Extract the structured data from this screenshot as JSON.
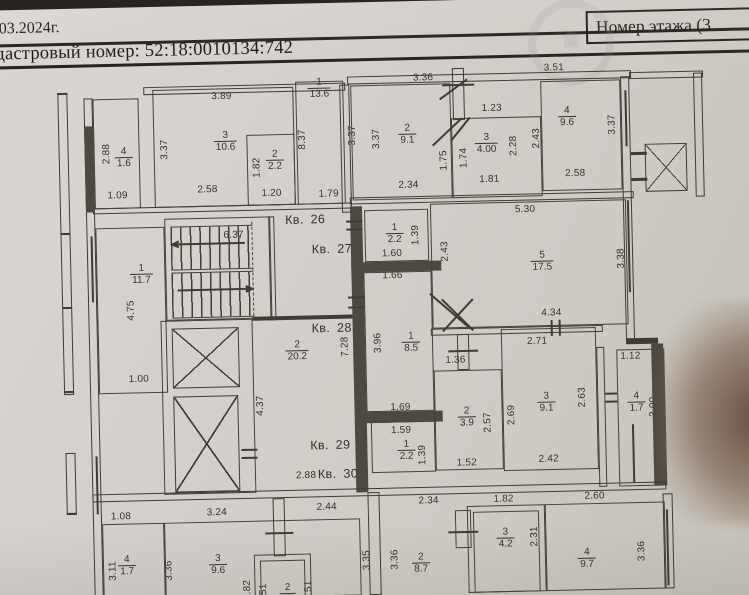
{
  "header": {
    "date_text": "03.2024г.",
    "cadastral_text": "дастровый номер: 52:18:0010134:742",
    "floor_box_label": "Номер этажа (3"
  },
  "colors": {
    "paper": "#d3d0cb",
    "ink": "#3f3c36",
    "header_ink": "#1d1b16"
  },
  "plan": {
    "apartment_labels": [
      {
        "text": "Кв. 26",
        "x": 307,
        "y": 218
      },
      {
        "text": "Кв. 27",
        "x": 333,
        "y": 248
      },
      {
        "text": "Кв. 28",
        "x": 331,
        "y": 327
      },
      {
        "text": "Кв. 29",
        "x": 327,
        "y": 444
      },
      {
        "text": "Кв. 30",
        "x": 334,
        "y": 473
      }
    ],
    "room_labels": [
      {
        "num": "4",
        "area": "1.6",
        "x": 127,
        "y": 152
      },
      {
        "num": "3",
        "area": "10.6",
        "x": 229,
        "y": 138
      },
      {
        "num": "2",
        "area": "2.2",
        "x": 278,
        "y": 158
      },
      {
        "num": "1",
        "area": "13.6",
        "x": 324,
        "y": 87
      },
      {
        "num": "2",
        "area": "9.1",
        "x": 411,
        "y": 135
      },
      {
        "num": "3",
        "area": "4.00",
        "x": 490,
        "y": 146
      },
      {
        "num": "4",
        "area": "9.6",
        "x": 571,
        "y": 121
      },
      {
        "num": "1",
        "area": "11.7",
        "x": 142,
        "y": 269
      },
      {
        "num": "1",
        "area": "2.2",
        "x": 396,
        "y": 234
      },
      {
        "num": "5",
        "area": "17.5",
        "x": 543,
        "y": 265
      },
      {
        "num": "2",
        "area": "20.2",
        "x": 296,
        "y": 349
      },
      {
        "num": "1",
        "area": "8.5",
        "x": 410,
        "y": 343
      },
      {
        "num": "1",
        "area": "2.2",
        "x": 403,
        "y": 451
      },
      {
        "num": "2",
        "area": "3.9",
        "x": 464,
        "y": 419
      },
      {
        "num": "3",
        "area": "9.1",
        "x": 544,
        "y": 406
      },
      {
        "num": "4",
        "area": "1.7",
        "x": 634,
        "y": 408
      },
      {
        "num": "4",
        "area": "1.7",
        "x": 121,
        "y": 560
      },
      {
        "num": "3",
        "area": "9.6",
        "x": 212,
        "y": 561
      },
      {
        "num": "2",
        "area": "8.7",
        "x": 415,
        "y": 564
      },
      {
        "num": "3",
        "area": "4.2",
        "x": 500,
        "y": 541
      },
      {
        "num": "4",
        "area": "9.7",
        "x": 581,
        "y": 563
      },
      {
        "num": "2",
        "area": "",
        "x": 281,
        "y": 586
      }
    ],
    "dim_labels": [
      {
        "text": "3.89",
        "x": 226,
        "y": 93
      },
      {
        "text": "2.88",
        "x": 110,
        "y": 148,
        "rot": true
      },
      {
        "text": "1.09",
        "x": 120,
        "y": 190
      },
      {
        "text": "3.37",
        "x": 168,
        "y": 145,
        "rot": true
      },
      {
        "text": "2.58",
        "x": 210,
        "y": 186
      },
      {
        "text": "1.82",
        "x": 260,
        "y": 165,
        "rot": true
      },
      {
        "text": "1.20",
        "x": 274,
        "y": 191
      },
      {
        "text": "8.37",
        "x": 306,
        "y": 138,
        "rot": true
      },
      {
        "text": "1.79",
        "x": 331,
        "y": 193
      },
      {
        "text": "3.36",
        "x": 428,
        "y": 79
      },
      {
        "text": "3.51",
        "x": 559,
        "y": 72
      },
      {
        "text": "3.37",
        "x": 356,
        "y": 135,
        "rot": true
      },
      {
        "text": "3.37",
        "x": 380,
        "y": 139,
        "rot": true
      },
      {
        "text": "2.34",
        "x": 411,
        "y": 186
      },
      {
        "text": "1.23",
        "x": 496,
        "y": 111
      },
      {
        "text": "1.75",
        "x": 447,
        "y": 162,
        "rot": true
      },
      {
        "text": "1.74",
        "x": 467,
        "y": 160,
        "rot": true
      },
      {
        "text": "2.28",
        "x": 517,
        "y": 149,
        "rot": true
      },
      {
        "text": "1.81",
        "x": 492,
        "y": 182
      },
      {
        "text": "2.43",
        "x": 540,
        "y": 142,
        "rot": true
      },
      {
        "text": "2.58",
        "x": 578,
        "y": 178
      },
      {
        "text": "3.37",
        "x": 616,
        "y": 130,
        "rot": true
      },
      {
        "text": "6.37",
        "x": 235,
        "y": 232
      },
      {
        "text": "4.75",
        "x": 131,
        "y": 305,
        "rot": true
      },
      {
        "text": "1.00",
        "x": 137,
        "y": 374
      },
      {
        "text": "1.60",
        "x": 393,
        "y": 254
      },
      {
        "text": "1.39",
        "x": 417,
        "y": 236,
        "rot": true
      },
      {
        "text": "1.66",
        "x": 393,
        "y": 276
      },
      {
        "text": "5.30",
        "x": 527,
        "y": 213
      },
      {
        "text": "2.43",
        "x": 446,
        "y": 253,
        "rot": true
      },
      {
        "text": "3.38",
        "x": 622,
        "y": 264,
        "rot": true
      },
      {
        "text": "4.34",
        "x": 551,
        "y": 317
      },
      {
        "text": "7.28",
        "x": 344,
        "y": 346,
        "rot": true
      },
      {
        "text": "3.96",
        "x": 377,
        "y": 343,
        "rot": true
      },
      {
        "text": "2.71",
        "x": 536,
        "y": 345
      },
      {
        "text": "1.36",
        "x": 454,
        "y": 362
      },
      {
        "text": "4.37",
        "x": 258,
        "y": 403,
        "rot": true
      },
      {
        "text": "1.69",
        "x": 398,
        "y": 408
      },
      {
        "text": "1.59",
        "x": 398,
        "y": 431
      },
      {
        "text": "1.39",
        "x": 419,
        "y": 456,
        "rot": true
      },
      {
        "text": "2.88",
        "x": 302,
        "y": 474
      },
      {
        "text": "2.57",
        "x": 485,
        "y": 425,
        "rot": true
      },
      {
        "text": "1.52",
        "x": 463,
        "y": 465
      },
      {
        "text": "2.69",
        "x": 509,
        "y": 418,
        "rot": true
      },
      {
        "text": "2.42",
        "x": 545,
        "y": 463
      },
      {
        "text": "2.63",
        "x": 580,
        "y": 402,
        "rot": true
      },
      {
        "text": "1.12",
        "x": 629,
        "y": 362
      },
      {
        "text": "3.00",
        "x": 651,
        "y": 413,
        "rot": true
      },
      {
        "text": "1.08",
        "x": 116,
        "y": 511
      },
      {
        "text": "3.24",
        "x": 212,
        "y": 509
      },
      {
        "text": "2.44",
        "x": 322,
        "y": 506
      },
      {
        "text": "2.34",
        "x": 424,
        "y": 502
      },
      {
        "text": "1.82",
        "x": 499,
        "y": 502
      },
      {
        "text": "2.60",
        "x": 590,
        "y": 501
      },
      {
        "text": "3.11",
        "x": 107,
        "y": 565,
        "rot": true
      },
      {
        "text": "3.36",
        "x": 163,
        "y": 566,
        "rot": true
      },
      {
        "text": "3.35",
        "x": 361,
        "y": 560,
        "rot": true
      },
      {
        "text": "3.36",
        "x": 389,
        "y": 560,
        "rot": true
      },
      {
        "text": "2.31",
        "x": 529,
        "y": 540,
        "rot": true
      },
      {
        "text": "3.36",
        "x": 636,
        "y": 557,
        "rot": true
      },
      {
        "text": "1.82",
        "x": 241,
        "y": 587,
        "rot": true
      },
      {
        "text": "1.51",
        "x": 257,
        "y": 591,
        "rot": true
      },
      {
        "text": "1.51",
        "x": 302,
        "y": 589,
        "rot": true
      }
    ]
  }
}
